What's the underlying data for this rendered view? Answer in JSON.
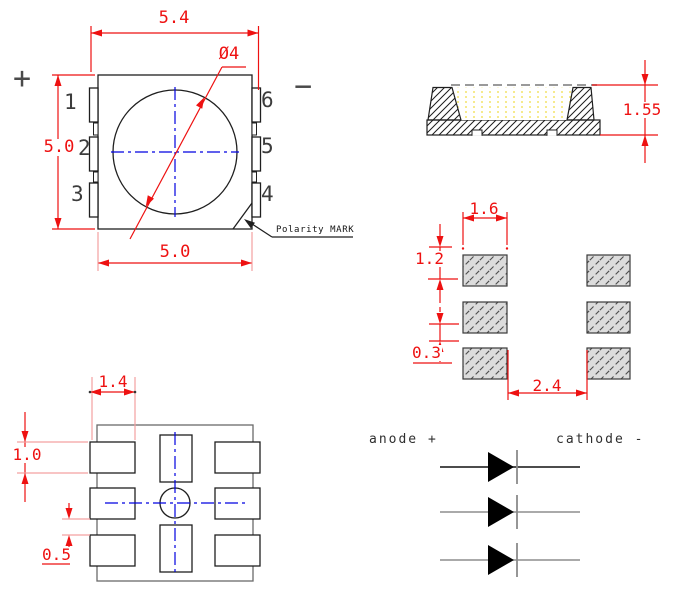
{
  "drawing": {
    "top_view": {
      "dim_overall_width": "5.4",
      "dim_body_height": "5.0",
      "dim_body_width": "5.0",
      "dim_lens_diameter": "Ø4",
      "pins_left": [
        "1",
        "2",
        "3"
      ],
      "pins_right": [
        "6",
        "5",
        "4"
      ],
      "polarity_plus": "+",
      "polarity_minus": "−",
      "polarity_mark_label": "Polarity MARK"
    },
    "side_view": {
      "dim_total_height": "1.55"
    },
    "solder_pad_layout": {
      "dim_pad_width": "1.6",
      "dim_pad_pitch": "1.2",
      "dim_pad_gap": "0.3",
      "dim_column_gap": "2.4"
    },
    "bottom_view": {
      "dim_pad_width": "1.4",
      "dim_pad_height": "1.0",
      "dim_pad_gap": "0.5"
    },
    "circuit": {
      "anode_label": "anode +",
      "cathode_label": "cathode -",
      "diode_count": 3
    },
    "colors": {
      "dimension_red": "#ee1111",
      "extension_pink": "#f4a0a0",
      "centerline_blue": "#0000e0",
      "line_black": "#1f1f1f",
      "line_gray": "#6a6a6a",
      "encapsulant_yellow": "#f0dc3c",
      "pad_fill_gray": "#dcdcdc"
    }
  }
}
